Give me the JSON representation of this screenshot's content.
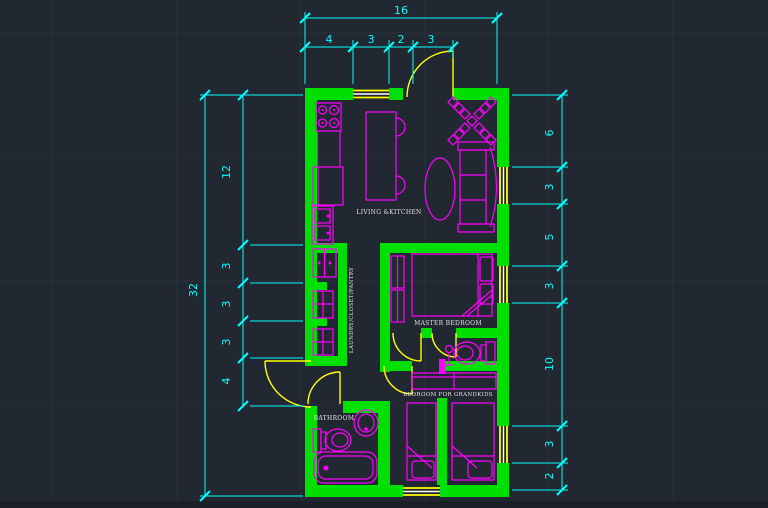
{
  "colors": {
    "background": "#222831",
    "wall": "#00e000",
    "furniture": "#ff00ff",
    "door": "#ffff00",
    "window_accent": "#ffffff",
    "dimension": "#00ffff",
    "label": "#e0e0e0"
  },
  "rooms": {
    "living_kitchen": {
      "label": "LIVING &KITCHEN"
    },
    "laundry": {
      "label": "LAUNDRY/CLOSET/PANTRY"
    },
    "master_bedroom": {
      "label": "MASTER BEDROOM"
    },
    "bathroom": {
      "label": "BATHROOM"
    },
    "grandkids_bedroom": {
      "label": "BEDROOM FOR GRANDKIDS"
    }
  },
  "dimensions": {
    "top": {
      "overall": "16",
      "segments": [
        "4",
        "3",
        "2",
        "3"
      ]
    },
    "left": {
      "overall": "32",
      "segments": [
        "12",
        "3",
        "3",
        "3",
        "4"
      ]
    },
    "right": {
      "segments": [
        "6",
        "3",
        "5",
        "3",
        "10",
        "3",
        "2"
      ]
    }
  }
}
